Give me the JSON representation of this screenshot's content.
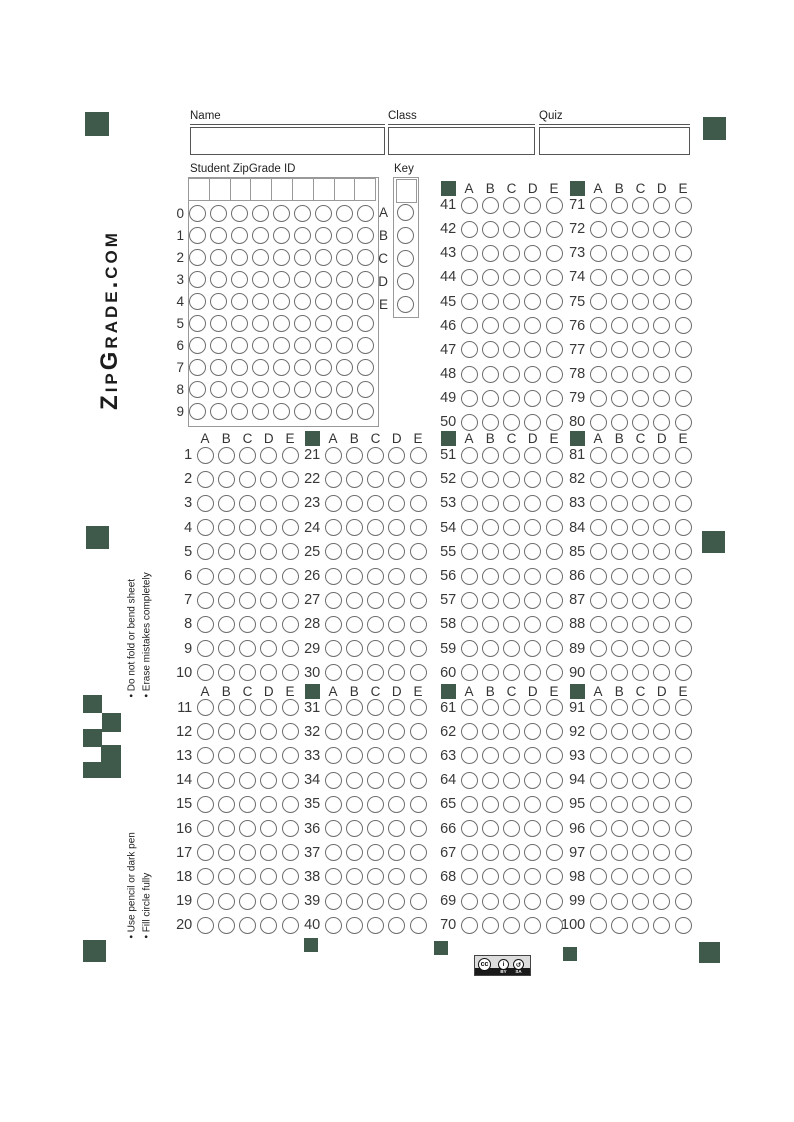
{
  "brand": "ZipGrade.com",
  "fields": {
    "name": "Name",
    "class": "Class",
    "quiz": "Quiz"
  },
  "id_section": {
    "title": "Student ZipGrade ID",
    "row_labels": [
      "0",
      "1",
      "2",
      "3",
      "4",
      "5",
      "6",
      "7",
      "8",
      "9"
    ],
    "num_columns": 9
  },
  "key_section": {
    "title": "Key",
    "row_labels": [
      "A",
      "B",
      "C",
      "D",
      "E"
    ]
  },
  "choice_labels": [
    "A",
    "B",
    "C",
    "D",
    "E"
  ],
  "questions_per_column": 10,
  "question_blocks": [
    {
      "columns": [
        {
          "first": 41,
          "marker": true,
          "slot": 2
        },
        {
          "first": 71,
          "marker": true,
          "slot": 3
        }
      ]
    },
    {
      "columns": [
        {
          "first": 1,
          "marker": false,
          "slot": 0
        },
        {
          "first": 21,
          "marker": true,
          "slot": 1
        },
        {
          "first": 51,
          "marker": true,
          "slot": 2
        },
        {
          "first": 81,
          "marker": true,
          "slot": 3
        }
      ]
    },
    {
      "columns": [
        {
          "first": 11,
          "marker": false,
          "slot": 0
        },
        {
          "first": 31,
          "marker": true,
          "slot": 1
        },
        {
          "first": 61,
          "marker": true,
          "slot": 2
        },
        {
          "first": 91,
          "marker": true,
          "slot": 3
        }
      ]
    }
  ],
  "instructions": {
    "handling": [
      "• Do not fold or bend sheet",
      "• Erase mistakes completely"
    ],
    "marking": [
      "• Use pencil or dark pen",
      "• Fill circle fully"
    ]
  },
  "license": {
    "label_cc": "cc",
    "label_by": "BY",
    "label_sa": "SA"
  },
  "colors": {
    "marker_green": "#3f5a4b"
  }
}
